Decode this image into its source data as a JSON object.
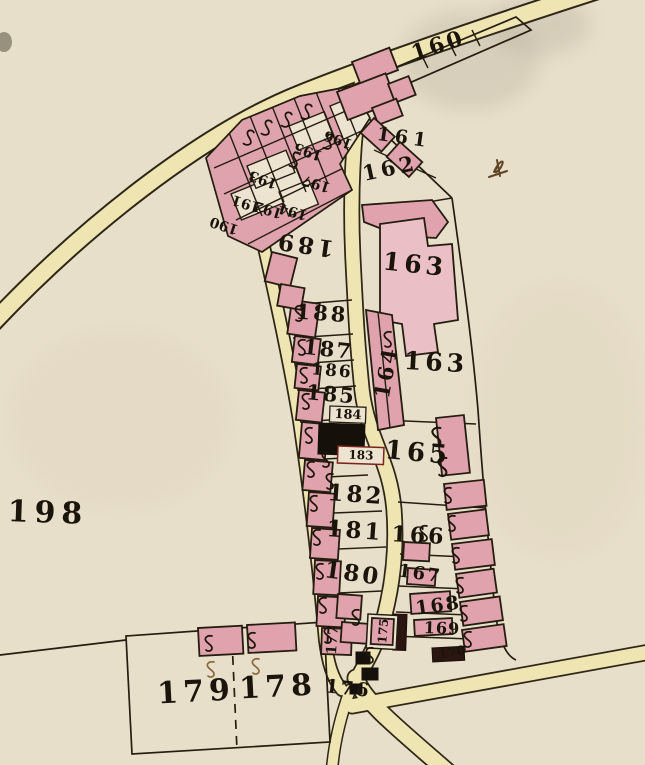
{
  "map": {
    "kind": "historical-cadastral-parish-map",
    "s_symbol": "S",
    "icons": {
      "s_mark": "script-s-flourish",
      "ink_mark": "ink-blot"
    },
    "colors": {
      "parchment": "#e8dfcb",
      "road_fill": "#efe5b2",
      "building_pink": "#e0a2ad",
      "building_black": "#15100a",
      "line_dark": "#241d10",
      "number_ink": "#1a140b",
      "brown_ink": "#8a6a3c"
    },
    "plot_labels": [
      {
        "id": "160",
        "label": "160"
      },
      {
        "id": "161",
        "label": "161"
      },
      {
        "id": "162",
        "label": "162"
      },
      {
        "id": "163-upper",
        "label": "163"
      },
      {
        "id": "163-lower",
        "label": "163"
      },
      {
        "id": "164",
        "label": "164"
      },
      {
        "id": "165",
        "label": "165"
      },
      {
        "id": "166",
        "label": "166"
      },
      {
        "id": "167",
        "label": "167"
      },
      {
        "id": "168",
        "label": "168"
      },
      {
        "id": "169",
        "label": "169"
      },
      {
        "id": "170",
        "label": "170"
      },
      {
        "id": "175",
        "label": "175"
      },
      {
        "id": "176",
        "label": "176"
      },
      {
        "id": "177",
        "label": "177"
      },
      {
        "id": "178",
        "label": "178"
      },
      {
        "id": "179",
        "label": "179"
      },
      {
        "id": "180",
        "label": "180"
      },
      {
        "id": "181",
        "label": "181"
      },
      {
        "id": "182",
        "label": "182"
      },
      {
        "id": "183",
        "label": "183"
      },
      {
        "id": "184",
        "label": "184"
      },
      {
        "id": "185",
        "label": "185"
      },
      {
        "id": "186",
        "label": "186"
      },
      {
        "id": "187",
        "label": "187"
      },
      {
        "id": "188",
        "label": "188"
      },
      {
        "id": "189",
        "label": "189"
      },
      {
        "id": "190",
        "label": "190"
      },
      {
        "id": "191",
        "label": "191"
      },
      {
        "id": "192",
        "label": "192"
      },
      {
        "id": "193",
        "label": "193"
      },
      {
        "id": "194",
        "label": "194"
      },
      {
        "id": "195",
        "label": "195"
      },
      {
        "id": "196",
        "label": "196"
      },
      {
        "id": "197",
        "label": "197"
      },
      {
        "id": "198",
        "label": "198"
      }
    ]
  }
}
